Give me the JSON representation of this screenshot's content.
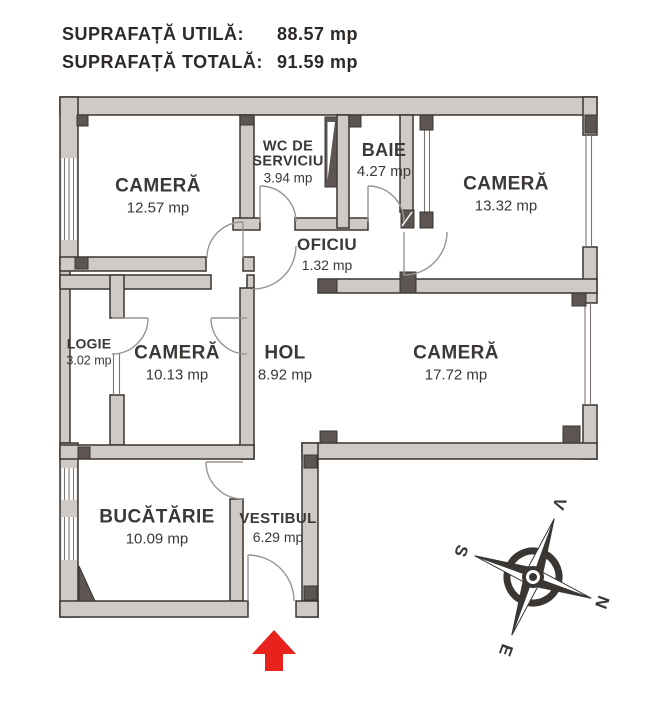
{
  "header": {
    "rows": [
      {
        "label": "SUPRAFAȚĂ UTILĂ:",
        "value": "88.57 mp"
      },
      {
        "label": "SUPRAFAȚĂ TOTALĂ:",
        "value": "91.59 mp"
      }
    ]
  },
  "rooms": [
    {
      "name": "CAMERĂ",
      "area": "12.57 mp"
    },
    {
      "name": "WC DE SERVICIU",
      "area": "3.94 mp"
    },
    {
      "name": "BAIE",
      "area": "4.27 mp"
    },
    {
      "name": "CAMERĂ",
      "area": "13.32 mp"
    },
    {
      "name": "OFICIU",
      "area": "1.32 mp"
    },
    {
      "name": "LOGIE",
      "area": "3.02 mp"
    },
    {
      "name": "CAMERĂ",
      "area": "10.13 mp"
    },
    {
      "name": "HOL",
      "area": "8.92 mp"
    },
    {
      "name": "CAMERĂ",
      "area": "17.72 mp"
    },
    {
      "name": "BUCĂTĂRIE",
      "area": "10.09 mp"
    },
    {
      "name": "VESTIBUL",
      "area": "6.29 mp"
    }
  ],
  "compass": {
    "north": "N",
    "south": "S",
    "east": "E",
    "west": "V"
  },
  "colors": {
    "wall": "#d0cac6",
    "wall_dark": "#5c5552",
    "outline": "#3a3532",
    "door_line": "#9a948f",
    "window_line": "#7c7672",
    "text": "#3c3835",
    "arrow_red": "#e8231d"
  }
}
